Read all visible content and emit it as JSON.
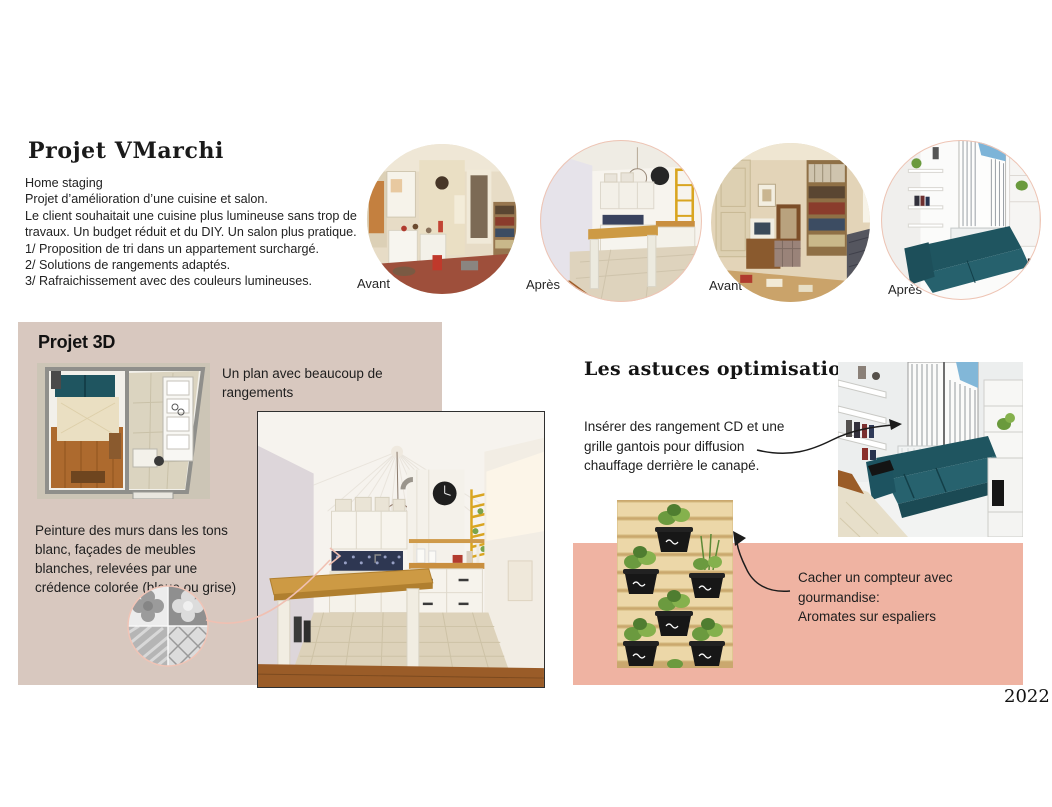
{
  "header": {
    "title": "Projet VMarchi",
    "intro_lines": [
      "Home staging",
      "Projet d’amélioration d’une cuisine et salon.",
      "Le client souhaitait une cuisine plus lumineuse sans trop de",
      "travaux. Un budget réduit et du DIY. Un salon plus pratique.",
      "1/ Proposition de tri dans un appartement surchargé.",
      "2/ Solutions de rangements adaptés.",
      "3/ Rafraichissement avec des couleurs lumineuses."
    ]
  },
  "before_after": {
    "items": [
      {
        "label": "Avant",
        "image": "kitchen-before-photo"
      },
      {
        "label": "Après",
        "image": "kitchen-after-photo"
      },
      {
        "label": "Avant",
        "image": "living-room-before-photo"
      },
      {
        "label": "Après",
        "image": "living-room-after-render"
      }
    ]
  },
  "projet3d": {
    "title": "Projet 3D",
    "plan_caption_lines": [
      "Un plan avec beaucoup de",
      "rangements"
    ],
    "paint_caption_lines": [
      "Peinture des murs dans les tons",
      "blanc, façades de meubles",
      "blanches, relevées par une",
      "crédence colorée (bleue ou grise)"
    ],
    "images": {
      "floor_plan": "Plan 3D de l'appartement",
      "kitchen_render": "Rendu 3D de la cuisine",
      "tile_swatch": "Carreaux de ciment gris (crédence)"
    }
  },
  "astuces": {
    "title": "Les astuces optimisation",
    "cd_caption_lines": [
      "Insérer des rangement CD et une",
      "grille gantois pour diffusion",
      "chauffage derrière le  canapé."
    ],
    "compteur_caption_lines": [
      "Cacher un compteur avec",
      "gourmandise:",
      "Aromates sur espaliers"
    ],
    "images": {
      "sofa_render": "Rendu 3D du canapé et rangements",
      "herb_wall": "Palette murale avec pots d'aromates"
    }
  },
  "footer": {
    "year": "2022"
  },
  "colors": {
    "panel_beige": "#d8c8bf",
    "panel_salmon": "#efb3a2",
    "sofa_teal": "#235c66",
    "text": "#1f1f1f",
    "accent_pink": "#f0c0b2",
    "wood": "#c98f3f"
  }
}
